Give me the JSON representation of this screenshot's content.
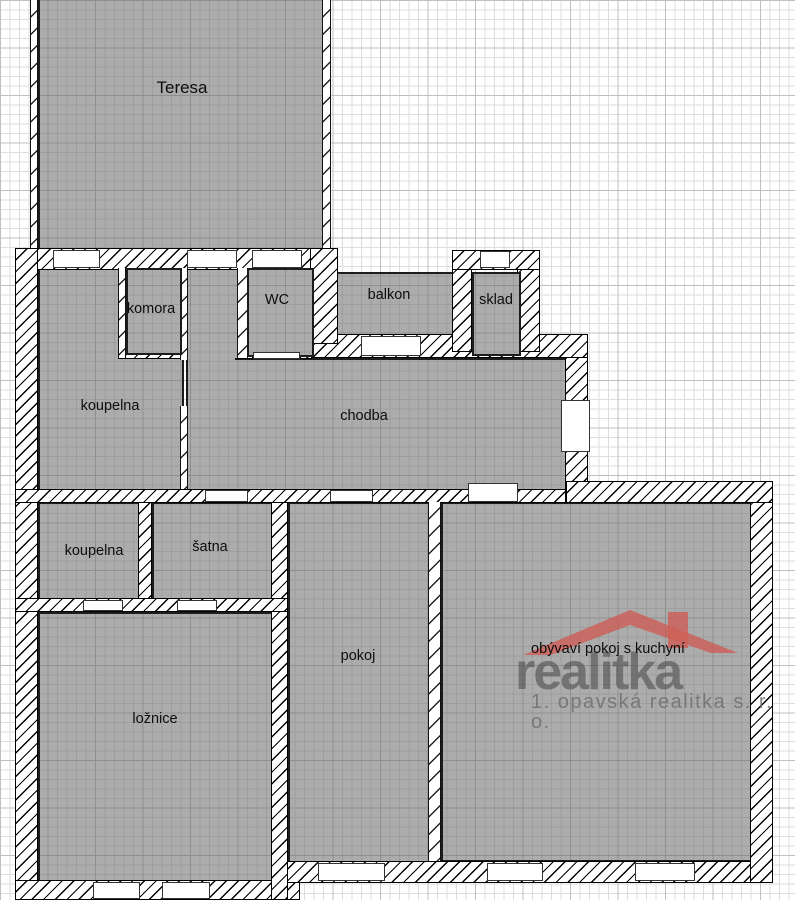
{
  "rooms": {
    "teresa": {
      "label": "Teresa"
    },
    "komora": {
      "label": "komora"
    },
    "wc": {
      "label": "WC"
    },
    "balkon": {
      "label": "balkon"
    },
    "sklad": {
      "label": "sklad"
    },
    "koupelna_horni": {
      "label": "koupelna"
    },
    "chodba": {
      "label": "chodba"
    },
    "koupelna_dolni": {
      "label": "koupelna"
    },
    "satna": {
      "label": "šatna"
    },
    "loznice": {
      "label": "ložnice"
    },
    "pokoj": {
      "label": "pokoj"
    },
    "obyvaci": {
      "label": "obývaví pokoj s kuchyní"
    }
  },
  "watermark": {
    "brand": "realitka",
    "subtitle": "1. opavská realitka s. r. o.",
    "roof_color": "#cd5f58",
    "text_color": "#6e6e6e"
  },
  "colors": {
    "room_fill": "#acacac",
    "wall_ink": "#000000",
    "grid_minor": "#dedede",
    "grid_major": "#bfbfbf"
  }
}
